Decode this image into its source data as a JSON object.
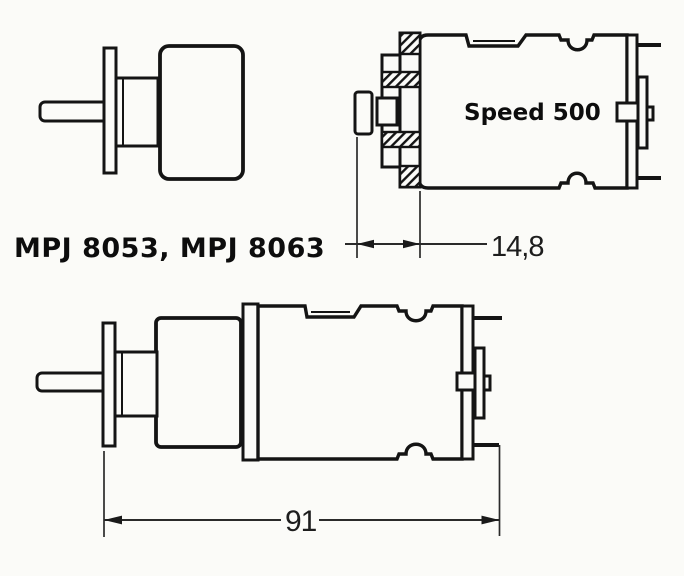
{
  "page": {
    "background": "#fbfbf8",
    "line_color": "#141414"
  },
  "diagram": {
    "product_label": "MPJ 8053, MPJ 8063",
    "motor_label": "Speed 500",
    "dimensions": {
      "pinion_protrusion": "14,8",
      "overall_length": "91"
    },
    "views": {
      "top_left": "gearbox-front-side-view",
      "top_right": "motor-pinion-section-view",
      "bottom": "gearmotor-full-side-view"
    }
  }
}
